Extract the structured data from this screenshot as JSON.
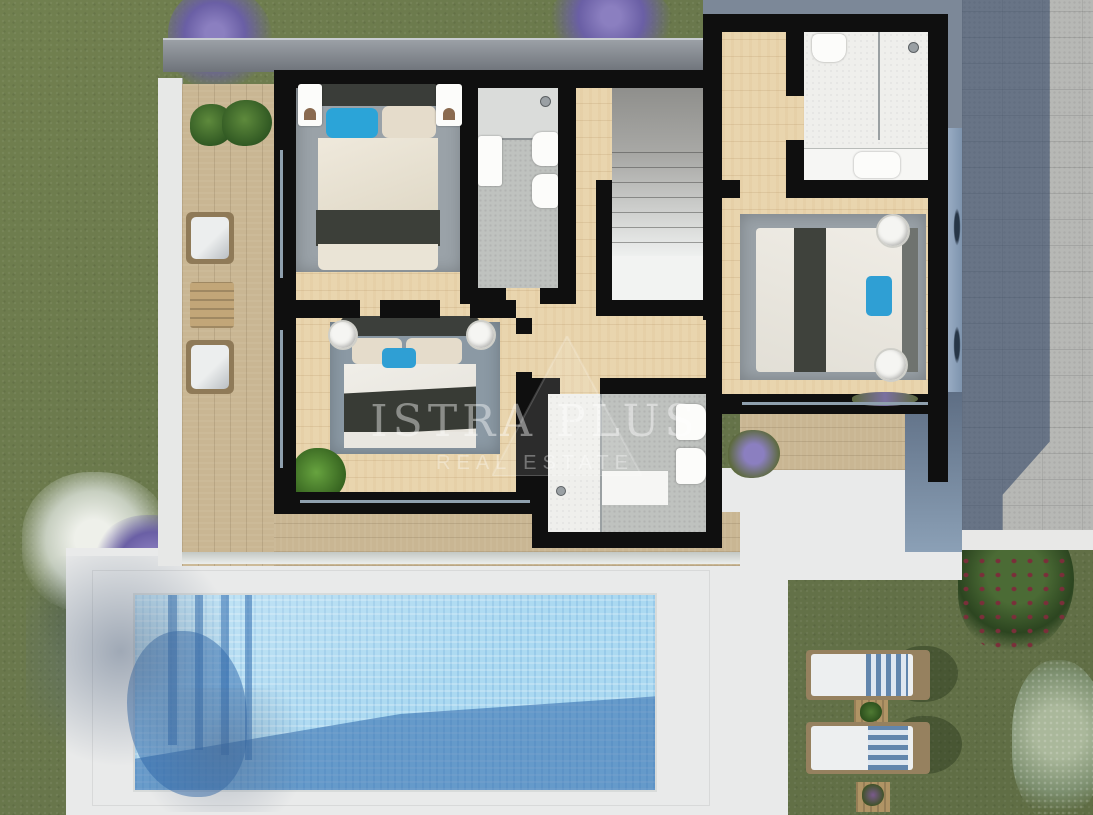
{
  "watermark": {
    "title": "ISTRA PLUS",
    "subtitle": "REAL ESTATE"
  },
  "palette": {
    "grass": "#6d7b4e",
    "wood_floor": "#e9d5ae",
    "terrace_wood": "#c9b693",
    "wall_black": "#0f0f0f",
    "roof_gray": "#80858c",
    "roof_blue": "#7c8898",
    "paving_light": "#b7b8b5",
    "paving_shadow": "#41587a",
    "deck_white": "#e9eaea",
    "pool_water": "#abd9f1",
    "pool_shadow": "#2e6cb0",
    "glass_blue": "#92a7c0",
    "rug_gray": "#9aa2a8",
    "rug_blue": "#8b99a4",
    "pillow_blue": "#2fa6d9",
    "blanket_dark": "#3c3f39",
    "tile_gray": "#bfc2bf",
    "tile_white": "#efefec",
    "flower_purple": "#7a6fb5",
    "flower_white": "#e7eae3",
    "shrub_red": "#6a3f44",
    "olive_green": "#9aa98a",
    "chair_wood": "#8f7a58",
    "cushion_white": "#eceeee",
    "towel_blue": "#5b7fa6"
  },
  "scene": {
    "type": "architectural-floor-plan-render",
    "rooms": [
      "bedroom-top-left",
      "bedroom-middle",
      "bedroom-right",
      "bathroom-top-middle",
      "bathroom-top-right",
      "bathroom-bottom",
      "staircase",
      "hallway"
    ],
    "outdoor": [
      "wood-terrace",
      "balcony",
      "swimming-pool",
      "pool-deck",
      "garden-lawn",
      "paved-driveway",
      "sun-loungers",
      "outdoor-armchairs"
    ]
  }
}
